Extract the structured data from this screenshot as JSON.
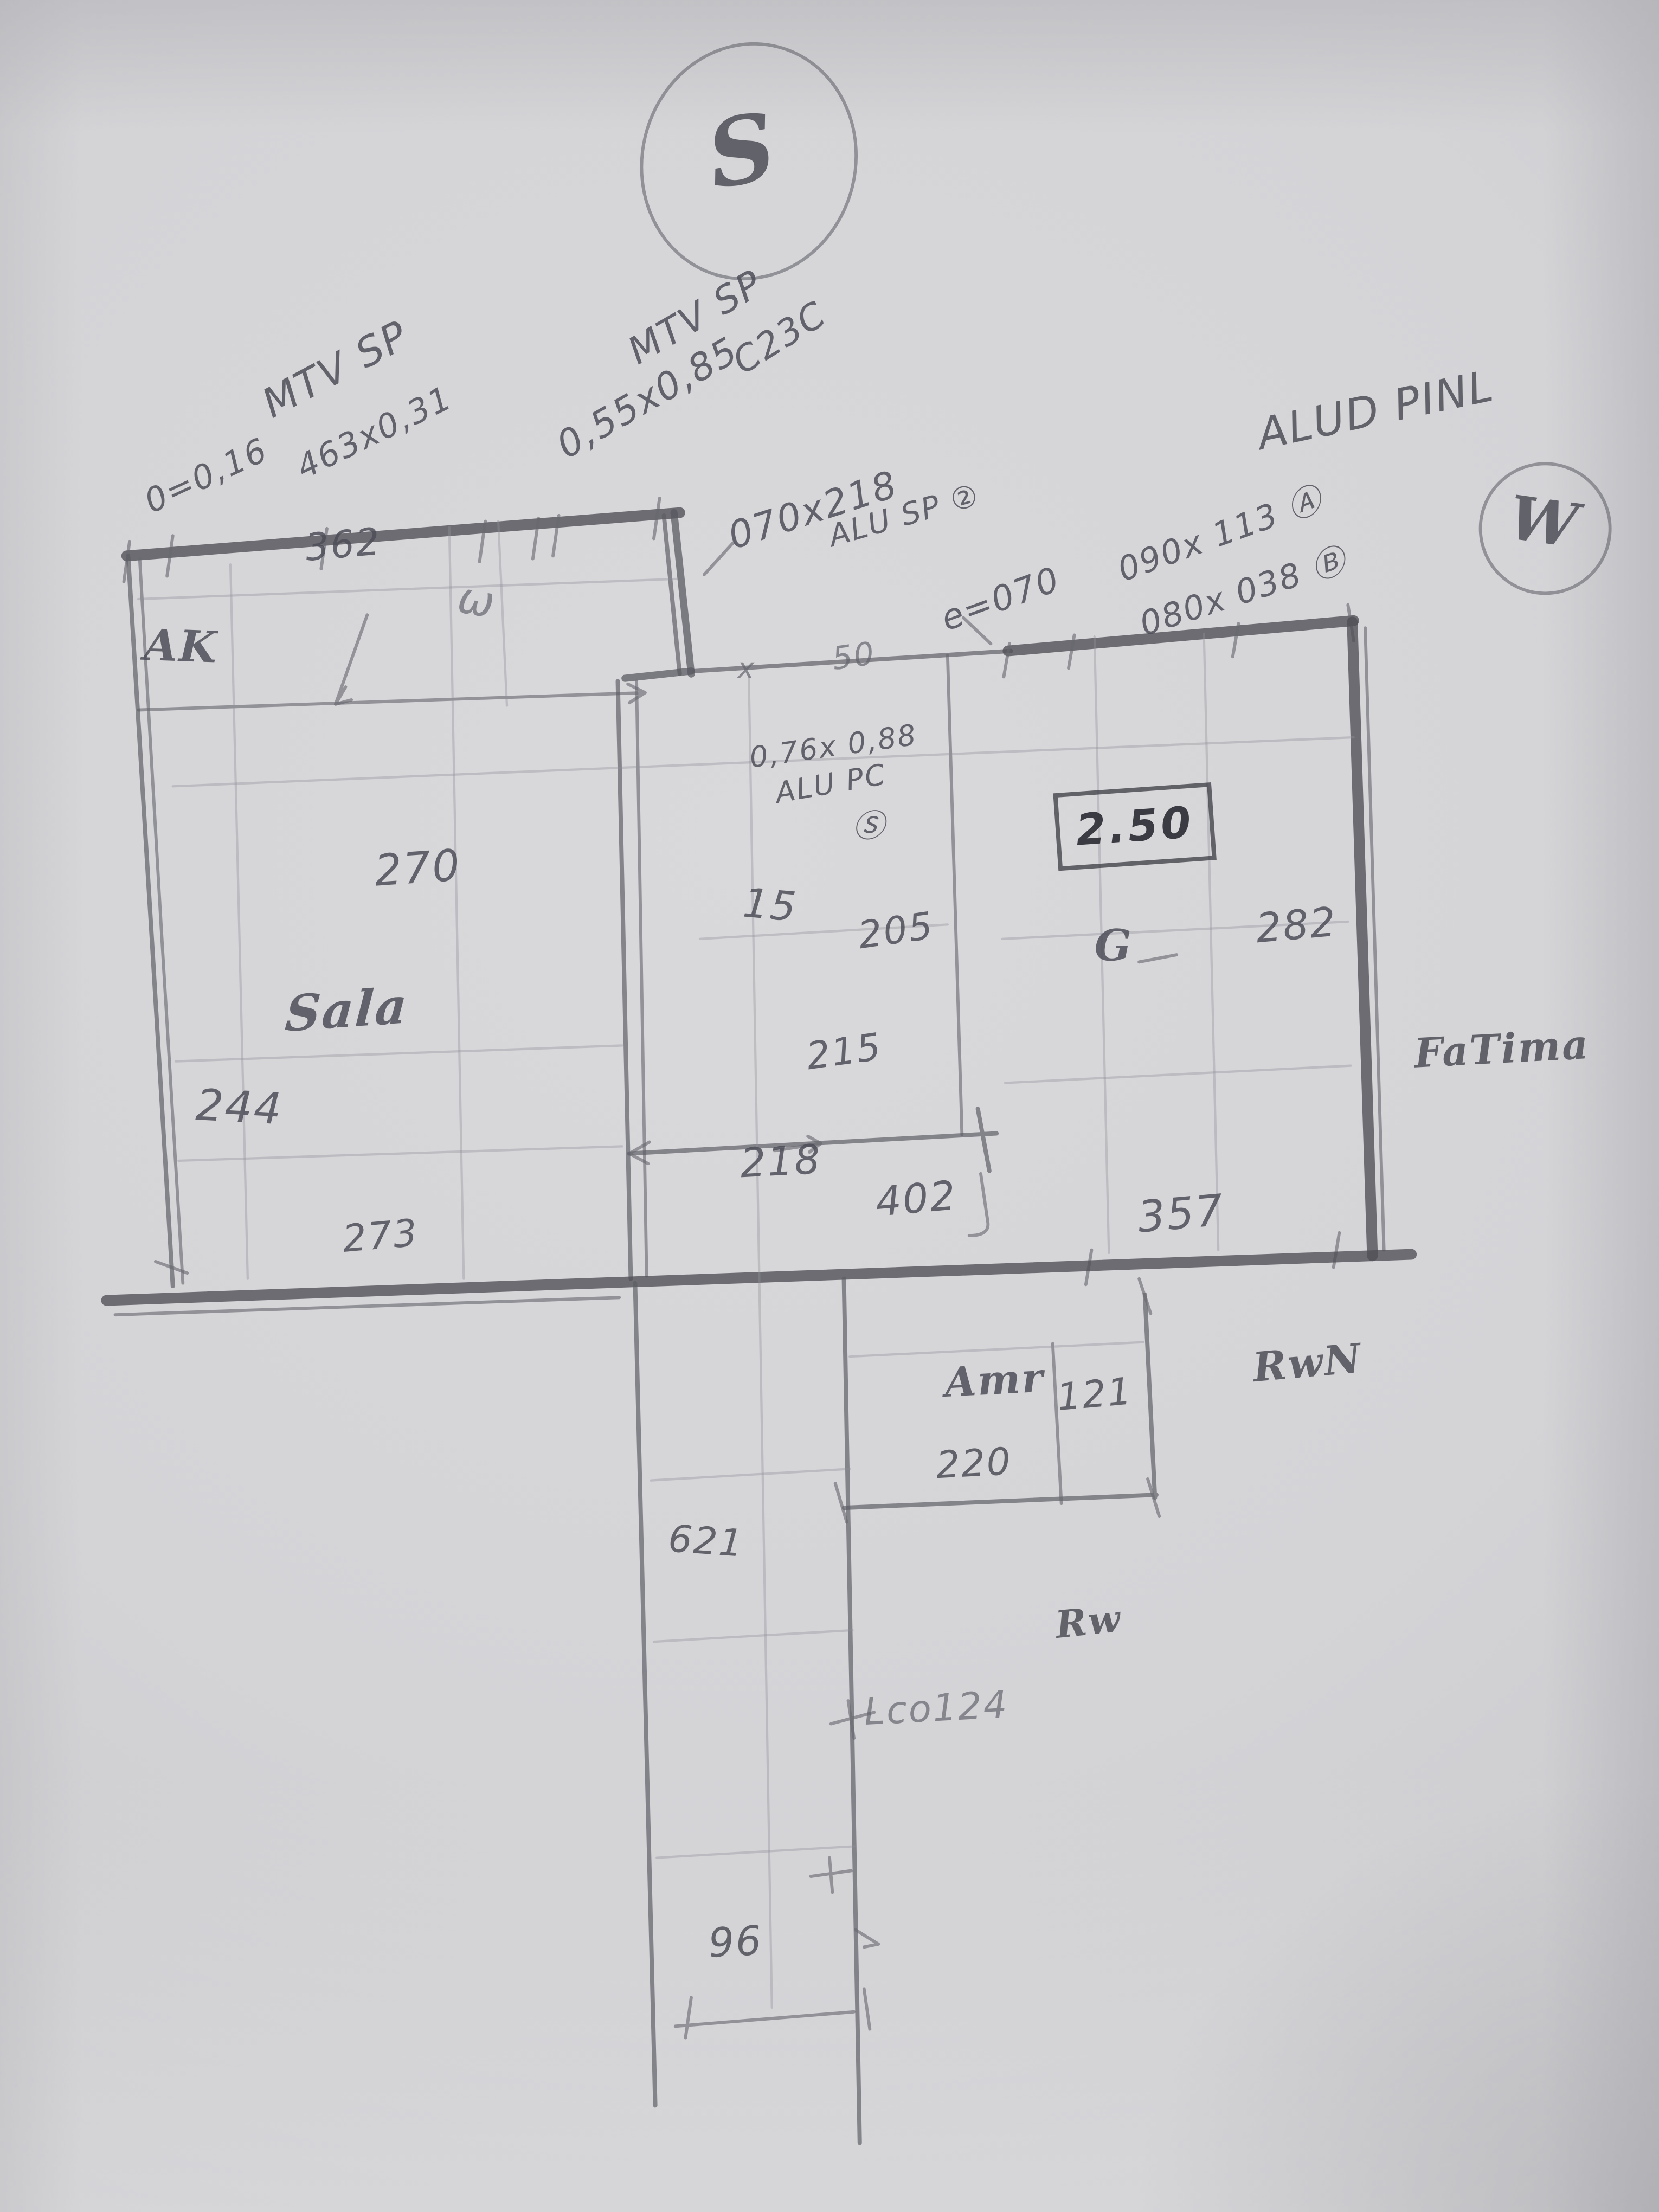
{
  "compass": {
    "south": "S",
    "west": "W"
  },
  "labels": {
    "mtv1_title": "MTV SP",
    "mtv1_sub1": "0=0,16",
    "mtv1_sub2": "463x0,31",
    "mtv2_title": "MTV SP",
    "mtv2_size": "0,55x0,85",
    "mtv2_code": "C23C",
    "door_size": "070x218",
    "door_type": "ALU SP ②",
    "alu_title": "ALUD PINL",
    "alu_line_a": "090x 113 Ⓐ",
    "alu_line_b": "080x 038 Ⓑ",
    "alu_e": "e=070",
    "win3_size": "0,76x 0,88",
    "win3_type": "ALU PC",
    "win3_mark": "Ⓢ",
    "x_mark": "x",
    "fifty_mark": "50",
    "w_mark": "ω",
    "g_mark": "G",
    "ak": "AK",
    "sala": "Sala",
    "fatima": "FaTima",
    "amr": "Amr",
    "rwan": "RwN",
    "rw": "Rw",
    "lco": "Lco124"
  },
  "dims": {
    "top": "362",
    "sala_mid": "270",
    "sala_left": "244",
    "sala_bottom": "273",
    "mid_width": "15",
    "d205": "205",
    "d215": "215",
    "d218": "218",
    "d402": "402",
    "boxed": "2.50",
    "right_height": "282",
    "d357": "357",
    "d121": "121",
    "d220": "220",
    "d621": "621",
    "d96": "96"
  }
}
